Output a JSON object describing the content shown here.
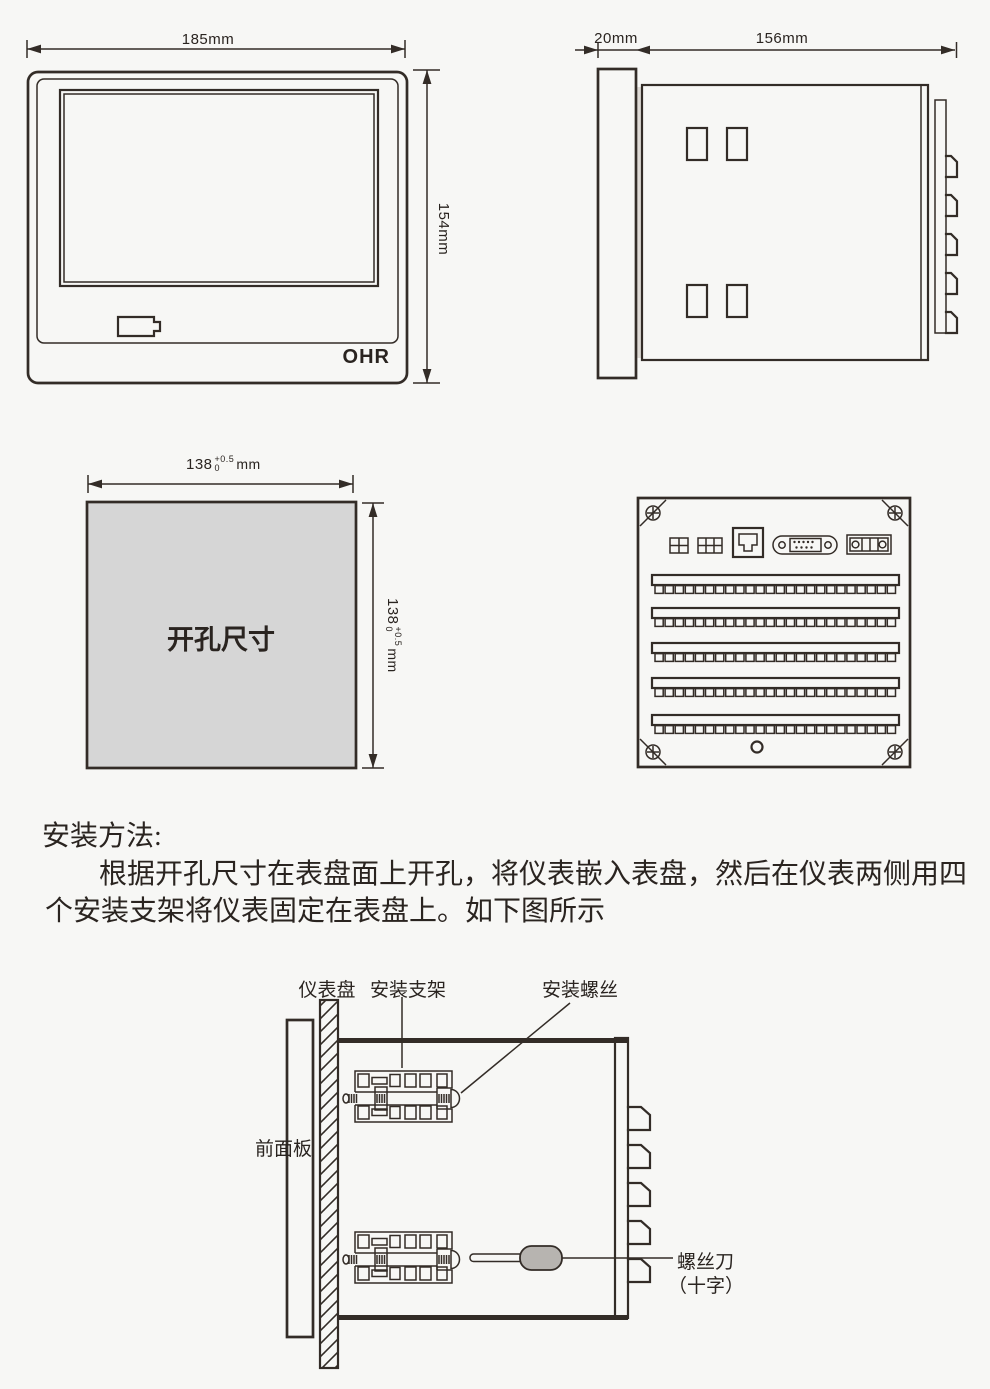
{
  "colors": {
    "ink": "#332c27",
    "cutout_fill": "#d6d6d6",
    "screwdriver_handle": "#b7b4b0",
    "background": "#f7f7f5"
  },
  "front_view": {
    "width_label": "185mm",
    "height_label": "154mm",
    "logo": "OHR"
  },
  "side_view": {
    "bezel_depth_label": "20mm",
    "body_depth_label": "156mm"
  },
  "cutout_view": {
    "title": "开孔尺寸",
    "width_dim": {
      "base": "138",
      "tol_plus": "+0.5",
      "tol_minus": "0",
      "unit": "mm"
    },
    "height_dim": {
      "base": "138",
      "tol_plus": "+0.5",
      "tol_minus": "0",
      "unit": "mm"
    }
  },
  "instructions": {
    "heading": "安装方法:",
    "line1": "根据开孔尺寸在表盘面上开孔，将仪表嵌入表盘，然后在仪表两侧用四",
    "line2": "个安装支架将仪表固定在表盘上。如下图所示"
  },
  "install_diagram": {
    "panel_label": "仪表盘",
    "bracket_label": "安装支架",
    "screw_label": "安装螺丝",
    "front_panel_label": "前面板",
    "screwdriver_label": "螺丝刀",
    "screwdriver_type_label": "（十字）"
  }
}
